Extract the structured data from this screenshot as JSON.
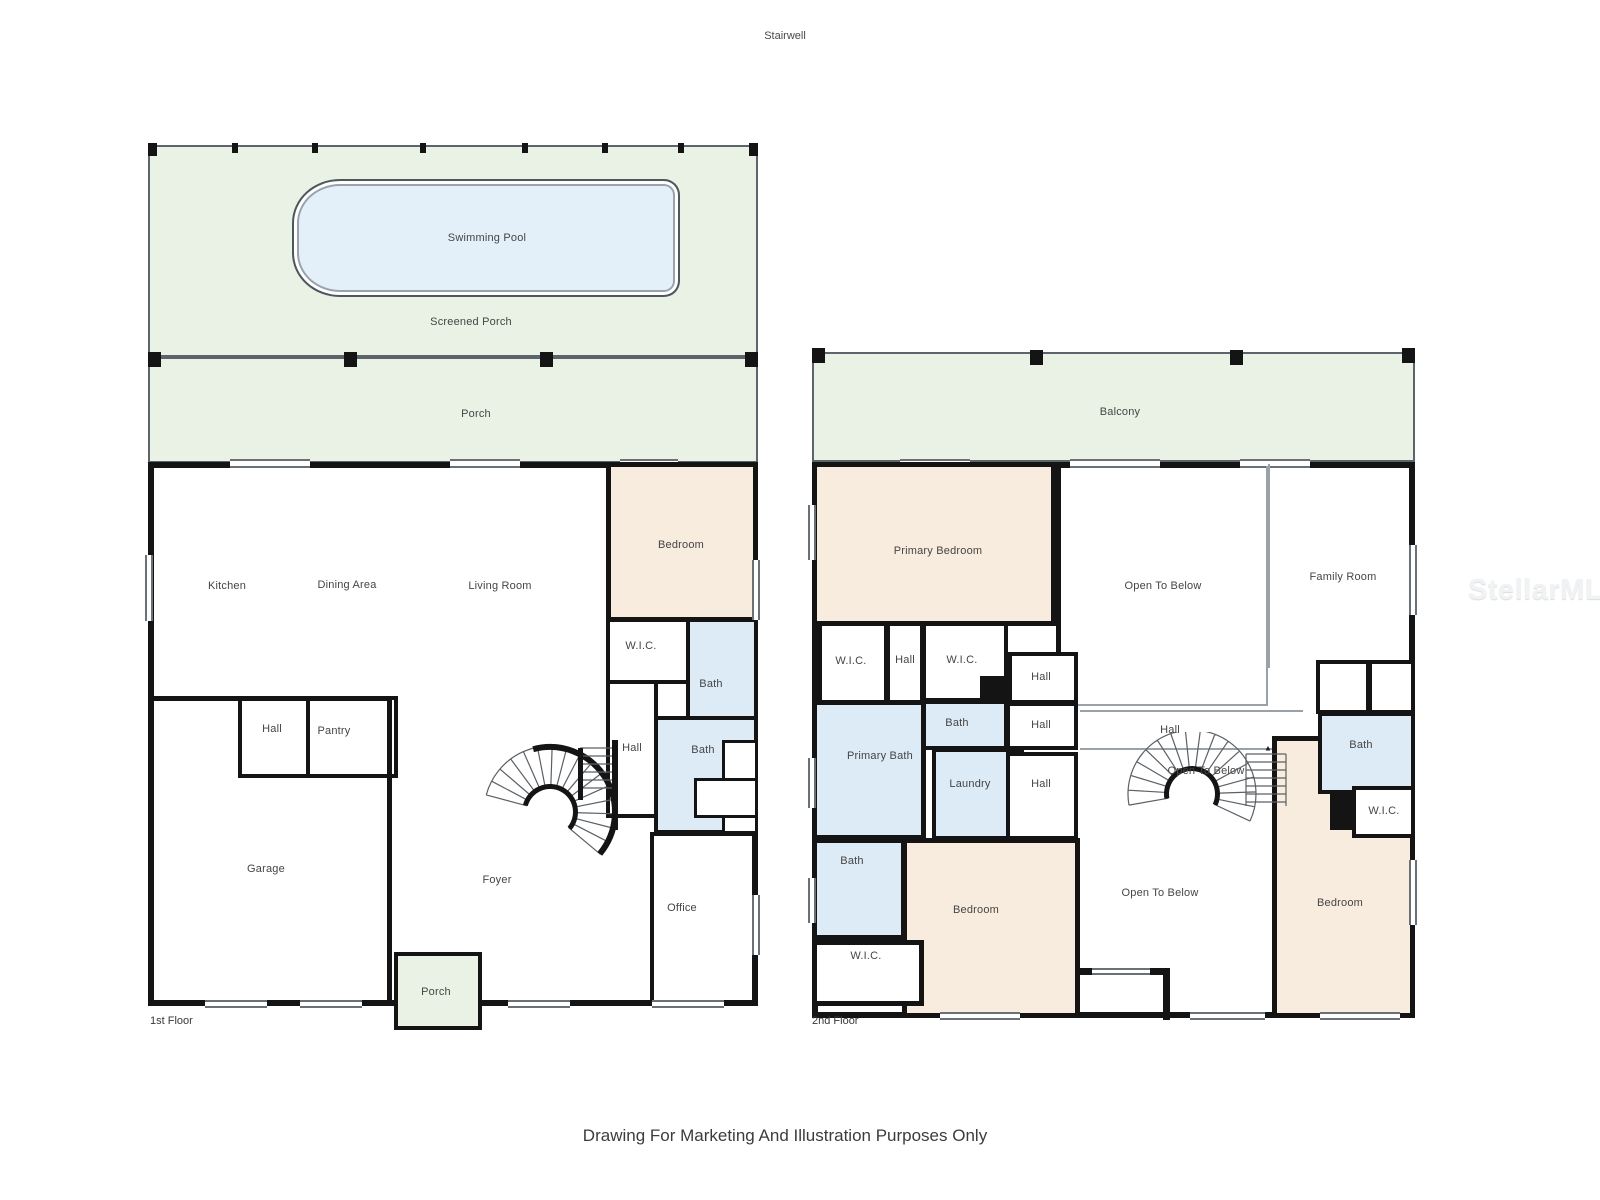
{
  "page": {
    "stairwell_label": "Stairwell",
    "disclaimer": "Drawing For Marketing And Illustration Purposes Only",
    "watermark": "StellarMLS"
  },
  "colors": {
    "wall": "#141414",
    "porch_green": "#e9f2e4",
    "pool_blue": "#e4f0f9",
    "bath_blue": "#dcebf6",
    "bedroom_peach": "#f8ecdf",
    "label_text": "#454545"
  },
  "floor1": {
    "name": "1st Floor",
    "labels": {
      "screened_porch": "Screened Porch",
      "swimming_pool": "Swimming Pool",
      "porch_back": "Porch",
      "kitchen": "Kitchen",
      "dining_area": "Dining Area",
      "living_room": "Living Room",
      "bedroom": "Bedroom",
      "wic": "W.I.C.",
      "bath_upper": "Bath",
      "hall_bath": "Hall",
      "bath_lower": "Bath",
      "hall": "Hall",
      "pantry": "Pantry",
      "garage": "Garage",
      "foyer": "Foyer",
      "office": "Office",
      "porch_front": "Porch"
    }
  },
  "floor2": {
    "name": "2nd Floor",
    "labels": {
      "balcony": "Balcony",
      "primary_bedroom": "Primary Bedroom",
      "open_to_below_top": "Open To Below",
      "family_room": "Family Room",
      "wic_a": "W.I.C.",
      "hall_a": "Hall",
      "wic_b": "W.I.C.",
      "hall_b": "Hall",
      "bath_small": "Bath",
      "hall_c": "Hall",
      "hall_long": "Hall",
      "primary_bath": "Primary Bath",
      "laundry": "Laundry",
      "hall_d": "Hall",
      "open_to_below_stairs": "Open To Below",
      "bath_right": "Bath",
      "wic_right": "W.I.C.",
      "bath_left": "Bath",
      "bedroom_center": "Bedroom",
      "wic_bottom": "W.I.C.",
      "open_to_below_bottom": "Open To Below",
      "bedroom_right": "Bedroom"
    }
  }
}
